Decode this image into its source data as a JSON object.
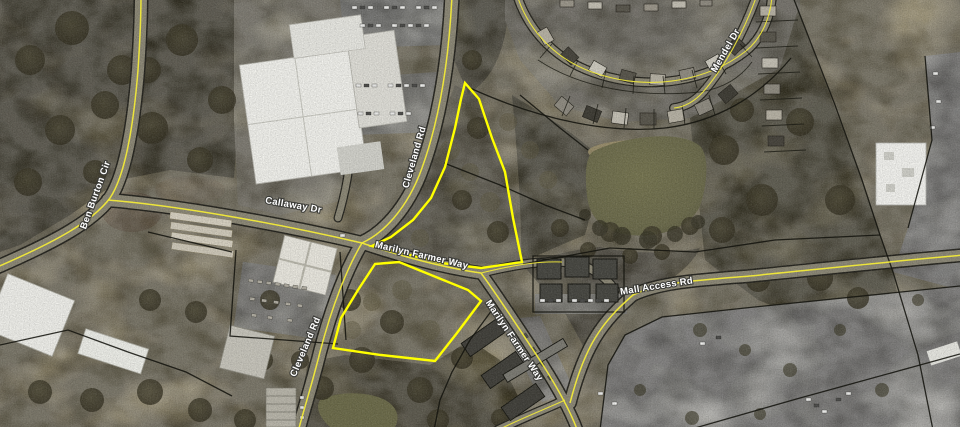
{
  "map": {
    "description": "Aerial parcel map with two selected parcels outlined in yellow",
    "colors": {
      "parcel_highlight": "#ffff00",
      "parcel_boundary": "#15150f",
      "road_centerline": "#f2ea38",
      "label_text": "#ffffff",
      "label_halo": "#3c3c38",
      "pond_water": "#6f6e4c"
    },
    "road_labels": [
      {
        "text": "Ben Burton Cir"
      },
      {
        "text": "Callaway Dr"
      },
      {
        "text": "Cleveland Rd"
      },
      {
        "text": "Cleveland Rd"
      },
      {
        "text": "Marilyn Farmer Way"
      },
      {
        "text": "Marilyn Farmer Way"
      },
      {
        "text": "Mall Access Rd"
      },
      {
        "text": "Mendel Dr"
      }
    ],
    "selected_parcels": [
      {
        "id": "north-parcel",
        "points": "465,83 479,99 492,138 505,172 513,218 522,262 481,268 441,263 406,254 372,246 391,237 413,220 431,198 445,167 455,128 461,99"
      },
      {
        "id": "south-parcel",
        "points": "375,264 399,262 468,290 481,301 457,333 435,361 381,355 333,348 341,318 358,290"
      }
    ]
  }
}
